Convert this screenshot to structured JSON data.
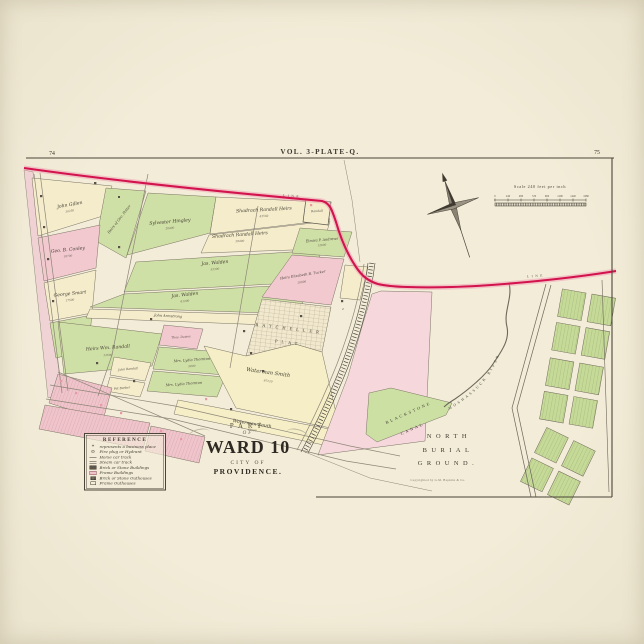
{
  "poster": {
    "background": "#f0ead6",
    "paper": "#f3eed9",
    "ink": "#3f3a31",
    "red_boundary": "#d2134d",
    "parcel_green": "#cfe0a6",
    "parcel_pink": "#f3c9d0",
    "parcel_cream": "#f4ecca",
    "parcel_yellow": "#f5eec6",
    "parcel_rose": "#f6d8dc"
  },
  "plate": {
    "title": "VOL. 3-PLATE-Q.",
    "page_left": "74",
    "page_right": "75"
  },
  "scale_bar": {
    "caption": "Scale 240 feet per inch",
    "ticks": [
      "0",
      "240",
      "480",
      "720",
      "960",
      "1200",
      "1440",
      "1680"
    ]
  },
  "legend": {
    "title": "REFERENCE",
    "items": [
      {
        "type": "star",
        "glyph": "*",
        "label": "represents a business place"
      },
      {
        "type": "hydrant",
        "glyph": "⊙",
        "label": "Fire plug or Hydrant"
      },
      {
        "type": "track-single",
        "glyph": "",
        "label": "Horse car track"
      },
      {
        "type": "track-double",
        "glyph": "",
        "label": "Steam car track"
      },
      {
        "type": "swatch-dark",
        "glyph": "",
        "label": "Brick or Stone Buildings"
      },
      {
        "type": "swatch-pink",
        "glyph": "",
        "label": "Frame Buildings"
      },
      {
        "type": "swatch-dark-small",
        "glyph": "",
        "label": "Brick or Stone Outhouses"
      },
      {
        "type": "swatch-outline",
        "glyph": "",
        "label": "Frame Outhouses"
      }
    ]
  },
  "cartouche": {
    "part": "PART",
    "of": "OF",
    "ward": "WARD 10",
    "city": "CITY OF",
    "providence": "PROVIDENCE."
  },
  "labels": {
    "burial_1": "NORTH",
    "burial_2": "BURIAL",
    "burial_3": "GROUND.",
    "canal_1": "BLACKSTONE",
    "canal_2": "CANAL",
    "river": "MOSHASSUCK RIVER",
    "plat_1": "BATCHELLER",
    "plat_2": "PLAT",
    "boundary": "LINE"
  },
  "parcels": [
    {
      "name": "John Gillen",
      "area": "30250"
    },
    {
      "name": "Heirs of Geo. Potter",
      "area": ""
    },
    {
      "name": "Geo. B. Conley",
      "area": "18700"
    },
    {
      "name": "George Smart",
      "area": "17500"
    },
    {
      "name": "Sylvester Hingley",
      "area": "20400"
    },
    {
      "name": "Shadrach Randall Heirs",
      "area": "43560"
    },
    {
      "name": "Shadrach Randall Heirs",
      "area": "38400"
    },
    {
      "name": "Jas. Walden",
      "area": "52300"
    },
    {
      "name": "Jas. Walden",
      "area": "61200"
    },
    {
      "name": "John Armstrong",
      "area": ""
    },
    {
      "name": "Elmira P. Andrews",
      "area": "12600"
    },
    {
      "name": "Randall",
      "area": ""
    },
    {
      "name": "Heirs Elizabeth B. Tucker",
      "area": "28900"
    },
    {
      "name": "Heirs Wm. Randall",
      "area": "32600"
    },
    {
      "name": "Thos. Davies",
      "area": ""
    },
    {
      "name": "Mrs. Lydia Thornton",
      "area": "9800"
    },
    {
      "name": "Mrs. Lydia Thornton",
      "area": ""
    },
    {
      "name": "John Randall",
      "area": ""
    },
    {
      "name": "Pat Barber",
      "area": ""
    },
    {
      "name": "Waterman Smith",
      "area": "87120"
    },
    {
      "name": "Waterman Smith",
      "area": "43560"
    }
  ],
  "annotations": {
    "copyright": "Copyrighted by G.M. Hopkins & Co.",
    "lot_number": "2"
  }
}
